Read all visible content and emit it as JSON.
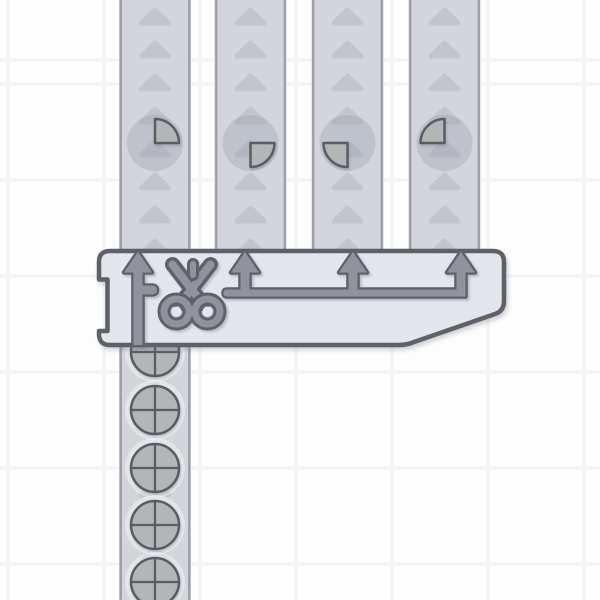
{
  "scene": {
    "game": "factory-belt-puzzle",
    "description": "A quad cutter machine with a scissors icon cuts whole circle shapes arriving on the input conveyor into four quarter pieces, ejected onto four upward-moving output conveyor belts.",
    "viewport": {
      "width": 600,
      "height": 600
    }
  },
  "colors": {
    "background": "#fdfdfe",
    "grid_line": "#f2f3f5",
    "belt_fill": "#d3d5da",
    "belt_border": "#9b9ea7",
    "belt_arrow": "#c2c5cb",
    "machine_fill": "#e4e6ec",
    "machine_outline": "#5d6169",
    "mechanism_fill": "#8f939d",
    "mechanism_outline": "#5d6169",
    "shape_fill": "#b4b5b7",
    "shape_outline": "#585c64",
    "halo_dark": "rgba(148,154,170,0.33)",
    "halo_light": "rgba(252,253,255,0.42)"
  },
  "grid": {
    "tile_size": 96,
    "offset_x": 8,
    "offset_y": 63,
    "line_width": 3
  },
  "belts": [
    {
      "id": "output-belt-1",
      "direction": "up",
      "x": 119,
      "width": 72,
      "y1": 0,
      "y2": 255,
      "arrow_first_y": 10,
      "arrow_step": 33,
      "items": [
        {
          "type": "quarter-top-right",
          "cx": 155,
          "cy": 143
        }
      ]
    },
    {
      "id": "output-belt-2",
      "direction": "up",
      "x": 214.5,
      "width": 72,
      "y1": 0,
      "y2": 255,
      "arrow_first_y": 10,
      "arrow_step": 33,
      "items": [
        {
          "type": "quarter-bottom-right",
          "cx": 250.5,
          "cy": 143
        }
      ]
    },
    {
      "id": "output-belt-3",
      "direction": "up",
      "x": 311.5,
      "width": 72,
      "y1": 0,
      "y2": 255,
      "arrow_first_y": 10,
      "arrow_step": 33,
      "items": [
        {
          "type": "quarter-bottom-left",
          "cx": 347.5,
          "cy": 143
        }
      ]
    },
    {
      "id": "output-belt-4",
      "direction": "up",
      "x": 408.5,
      "width": 72,
      "y1": 0,
      "y2": 255,
      "arrow_first_y": 10,
      "arrow_step": 33,
      "items": [
        {
          "type": "quarter-top-left",
          "cx": 444.5,
          "cy": 143
        }
      ]
    },
    {
      "id": "input-belt",
      "direction": "up",
      "x": 119,
      "width": 72,
      "y1": 337,
      "y2": 600,
      "arrow_first_y": 350,
      "arrow_step": 33,
      "items": [
        {
          "type": "circle-whole",
          "cx": 155,
          "cy": 352
        },
        {
          "type": "circle-whole",
          "cx": 155,
          "cy": 410
        },
        {
          "type": "circle-whole",
          "cx": 155,
          "cy": 468
        },
        {
          "type": "circle-whole",
          "cx": 155,
          "cy": 525
        },
        {
          "type": "circle-whole",
          "cx": 155,
          "cy": 582
        }
      ]
    }
  ],
  "machine": {
    "id": "quad-cutter",
    "name": "cutter-quad",
    "icon": "scissors-icon",
    "inputs": 1,
    "outputs": 4,
    "shape_radius": 24,
    "halo_radius_quarter": 28,
    "halo_radius_whole": 30
  }
}
